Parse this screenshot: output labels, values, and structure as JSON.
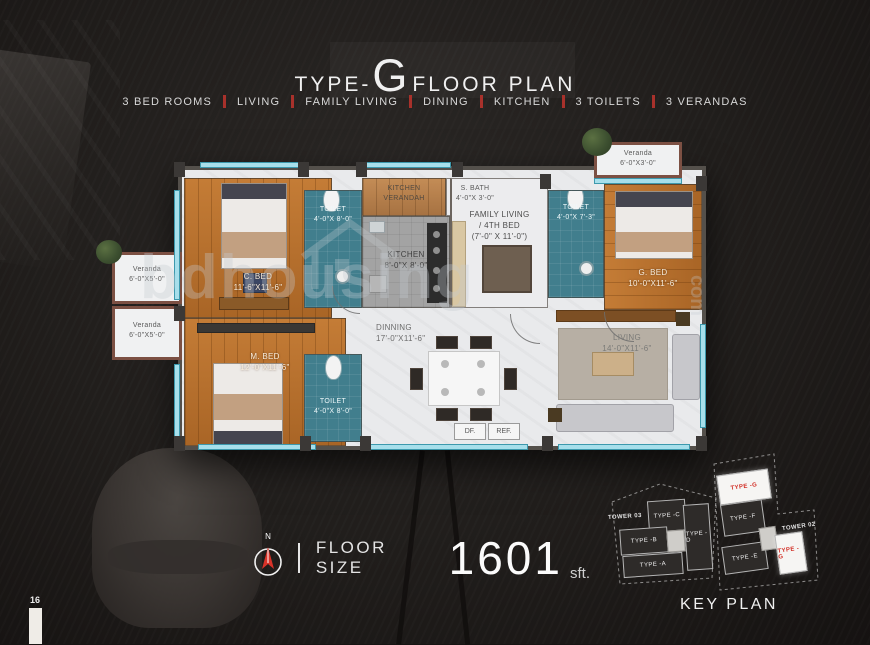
{
  "page": {
    "number": "16",
    "watermark": "bdhousing",
    "watermark_suffix": "com"
  },
  "header": {
    "title_prefix": "TYPE-",
    "title_letter": "G",
    "title_suffix": "FLOOR PLAN",
    "features": [
      "3 BED ROOMS",
      "LIVING",
      "FAMILY LIVING",
      "DINING",
      "KITCHEN",
      "3 TOILETS",
      "3 VERANDAS"
    ],
    "accent_color": "#a8312b"
  },
  "floor_plan": {
    "rooms": {
      "c_bed": {
        "name": "C. BED",
        "dims": "11'-6\"X11'-6\""
      },
      "m_bed": {
        "name": "M. BED",
        "dims": "12'-0\"X11'-6\""
      },
      "g_bed": {
        "name": "G. BED",
        "dims": "10'-0\"X11'-6\""
      },
      "toilet_left": {
        "name": "TOILET",
        "dims": "4'-0\"X 8'-0\""
      },
      "toilet_right": {
        "name": "TOILET",
        "dims": "4'-0\"X 7'-3\""
      },
      "toilet_bottom": {
        "name": "TOILET",
        "dims": "4'-0\"X 8'-0\""
      },
      "kitchen": {
        "name": "KITCHEN",
        "dims": "8'-0\"X 8'-0\""
      },
      "kitchen_verandah": {
        "name": "KITCHEN",
        "name2": "VERANDAH"
      },
      "s_bath": {
        "name": "S. BATH",
        "dims": "4'-0\"X 3'-0\""
      },
      "family_living": {
        "name": "FAMILY LIVING",
        "name2": "/ 4TH BED",
        "dims": "(7'-0\" X 11'-0\")"
      },
      "dining": {
        "name": "DINNING",
        "dims": "17'-0\"X11'-6\""
      },
      "living": {
        "name": "LIVING",
        "dims": "14'-0\"X11'-6\""
      },
      "veranda_left_top": {
        "name": "Veranda",
        "dims": "6'-0\"X5'-0\""
      },
      "veranda_left_bottom": {
        "name": "Veranda",
        "dims": "6'-0\"X5'-0\""
      },
      "veranda_top_right": {
        "name": "Veranda",
        "dims": "6'-0\"X3'-0\""
      },
      "df": "DF.",
      "ref": "REF."
    }
  },
  "floor_size": {
    "label": "FLOOR SIZE",
    "value": "1601",
    "unit": "sft.",
    "compass_letter": "N"
  },
  "key_plan": {
    "title": "KEY PLAN",
    "tower_03": {
      "label": "TOWER 03",
      "units": [
        "TYPE -C",
        "TYPE -B",
        "TYPE -D",
        "TYPE -A"
      ]
    },
    "tower_02": {
      "label": "TOWER 02",
      "units": [
        "TYPE -G",
        "TYPE -F",
        "TYPE -E",
        "TYPE -G"
      ]
    },
    "highlight_text_color": "#d22f26"
  }
}
